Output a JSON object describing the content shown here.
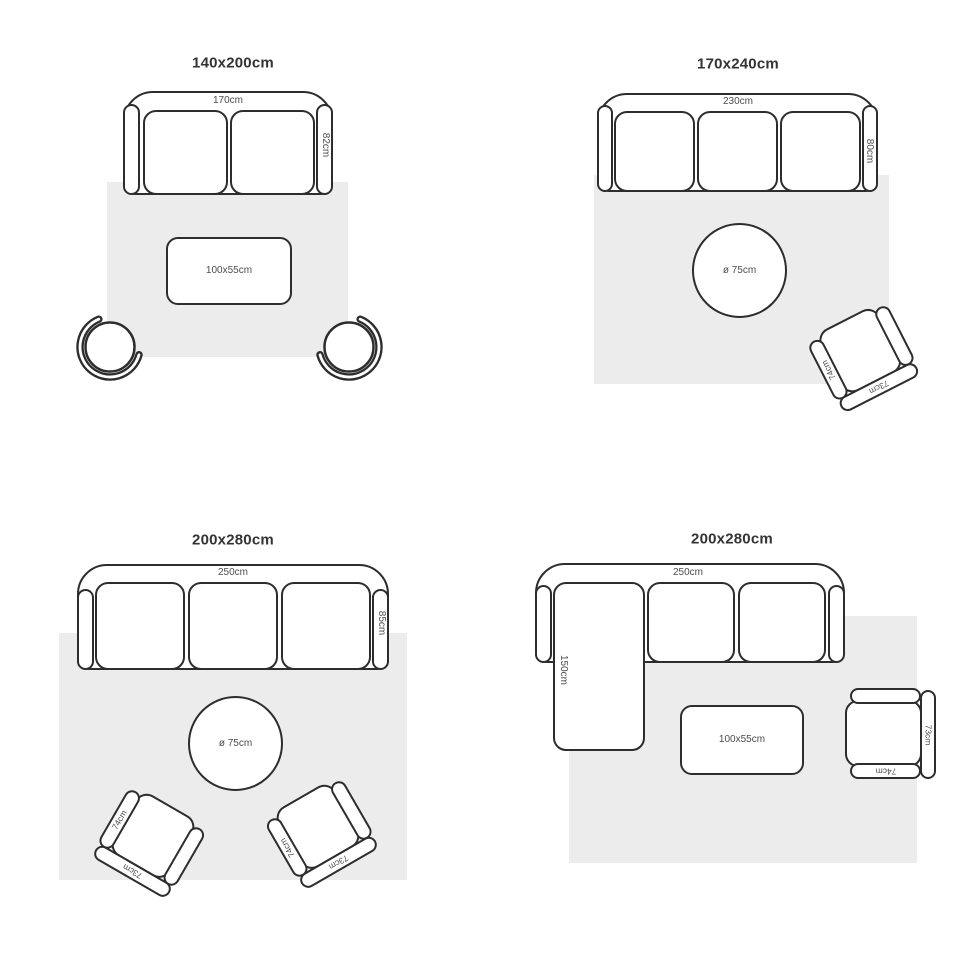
{
  "colors": {
    "line": "#2d2d2d",
    "rug": "#ececec",
    "dim_text": "#4d4d4d",
    "title_text": "#333333",
    "background": "#ffffff"
  },
  "quadrants": [
    {
      "title": "140x200cm",
      "sofa_width": "170cm",
      "sofa_depth": "82cm",
      "table_label": "100x55cm"
    },
    {
      "title": "170x240cm",
      "sofa_width": "230cm",
      "sofa_depth": "80cm",
      "table_label": "ø 75cm",
      "chair_arm": "74cm",
      "chair_back": "73cm"
    },
    {
      "title": "200x280cm",
      "sofa_width": "250cm",
      "sofa_depth": "85cm",
      "table_label": "ø 75cm",
      "chair1_arm": "74cm",
      "chair1_back": "73cm",
      "chair2_arm": "74cm",
      "chair2_back": "73cm"
    },
    {
      "title": "200x280cm",
      "sofa_width": "250cm",
      "chaise_depth": "150cm",
      "table_label": "100x55cm",
      "chair_arm": "74cm",
      "chair_back": "73cm"
    }
  ]
}
